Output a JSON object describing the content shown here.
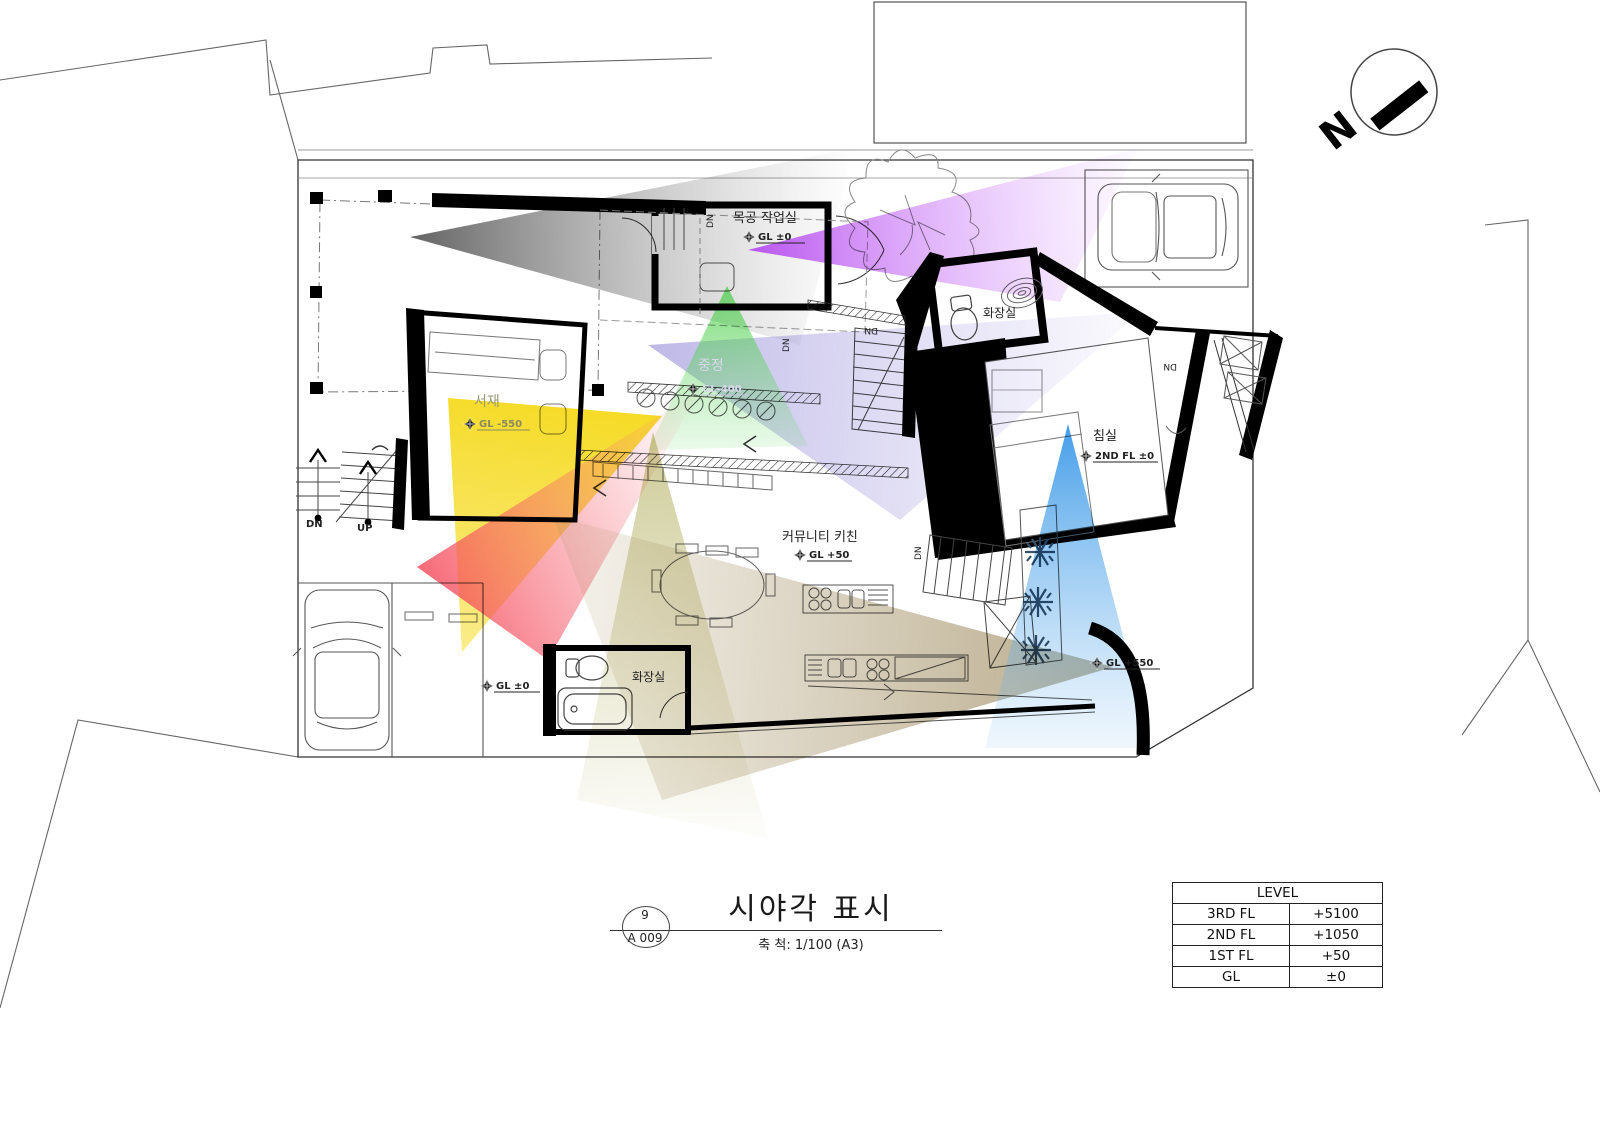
{
  "sheet": {
    "title": "시야각 표시",
    "scale": "축 척: 1/100 (A3)",
    "number": "9",
    "code": "A 009"
  },
  "north": {
    "label": "N"
  },
  "level_table": {
    "header": "LEVEL",
    "rows": [
      {
        "name": "3RD FL",
        "value": "+5100"
      },
      {
        "name": "2ND FL",
        "value": "+1050"
      },
      {
        "name": "1ST FL",
        "value": "+50"
      },
      {
        "name": "GL",
        "value": "±0"
      }
    ]
  },
  "rooms": {
    "woodshop": {
      "name": "목공 작업실",
      "level": "GL ±0"
    },
    "courtyard": {
      "name": "중정",
      "level": "GL-400"
    },
    "study": {
      "name": "서재",
      "level": "GL -550"
    },
    "bedroom": {
      "name": "침실",
      "level": "2ND FL ±0"
    },
    "community_kitchen": {
      "name": "커뮤니티 키친",
      "level": "GL +50"
    },
    "bathroom_upper": {
      "name": "화장실"
    },
    "bathroom_lower": {
      "name": "화장실"
    }
  },
  "site_levels": {
    "entry": "GL ±0",
    "terrace": "GL +550"
  },
  "stairs": {
    "dn": "DN",
    "up": "UP"
  },
  "view_cones": [
    {
      "name": "gray",
      "color": "#3c3c3c"
    },
    {
      "name": "magenta",
      "color": "#b84df0"
    },
    {
      "name": "violet",
      "color": "#7e72cf"
    },
    {
      "name": "green",
      "color": "#3ecb3e"
    },
    {
      "name": "yellow",
      "color": "#f4d500"
    },
    {
      "name": "red",
      "color": "#f54455"
    },
    {
      "name": "olive",
      "color": "#a5a040"
    },
    {
      "name": "tan",
      "color": "#8a7440"
    },
    {
      "name": "blue",
      "color": "#2f93e6"
    }
  ]
}
